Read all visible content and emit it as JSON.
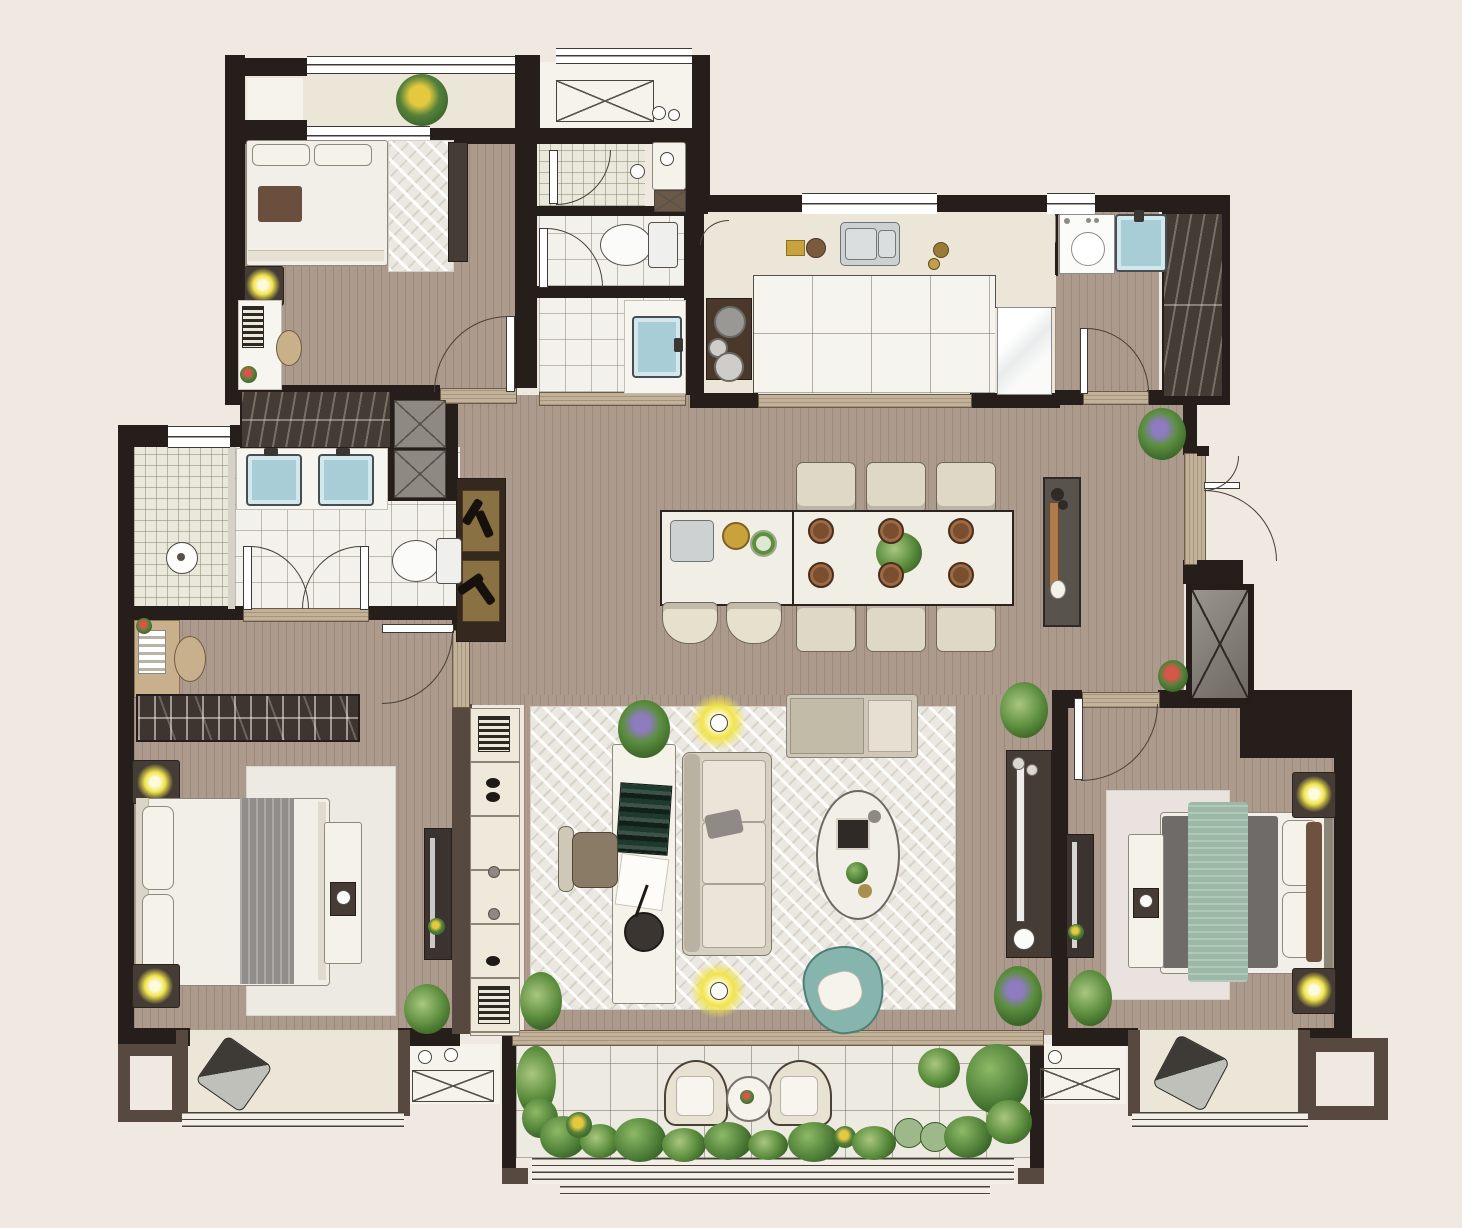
{
  "scene": {
    "type": "residential-floor-plan",
    "view": "top-down-render",
    "canvas_width": 1462,
    "canvas_height": 1228
  },
  "colors": {
    "bg": "#EFE9E1",
    "wall": "#261E1B",
    "wallSoft": "#57493F",
    "wood": "#AC9B8D",
    "woodLine": "rgba(74,52,40,0.16)",
    "tile": "#F3F1EB",
    "tileLine": "rgba(125,118,106,0.45)",
    "marble": "#EBE6D8",
    "balconyTile": "#EDEAE2",
    "showerTile": "#E9E8DB",
    "counter": "#F7F5EF",
    "stoneSill": "#C3B29A",
    "whiteFurn": "#F5F2EA",
    "darkFurn": "#453C36",
    "bed": "#F2EFE8",
    "runnerGray": "#918D8B",
    "runnerGreen": "#9BB9A6",
    "throwBrown": "#6B4F3E",
    "pillowBrown": "#6E523F",
    "teal": "#85B5AC",
    "lamp": "#F1E44C",
    "sinkBlue": "#A9CDD6",
    "stainless": "#CDD1D2",
    "glass": "#D6D2C8",
    "rug": "#EBE8E2",
    "tv": "#EDEDEB",
    "plantDark": "#2C521F",
    "plantMid": "#4F7F38",
    "plantLight": "#8CBA66"
  },
  "rooms": [
    {
      "id": "balcony-top-left",
      "items": [
        "potted-plant",
        "railing-window",
        "marble-floor"
      ]
    },
    {
      "id": "bedroom-guest",
      "items": [
        "double-bed",
        "brown-throw",
        "area-rug",
        "dresser",
        "nightstand-with-lamp",
        "desk",
        "stool",
        "built-in-wardrobe"
      ]
    },
    {
      "id": "bathroom-guest",
      "items": [
        "shower-room",
        "toilet",
        "vanity-sink",
        "service-shaft",
        "door-swing-x3"
      ]
    },
    {
      "id": "ac-platform-north",
      "items": [
        "unit-outline-x-box",
        "vent-circles",
        "railing"
      ]
    },
    {
      "id": "kitchen",
      "items": [
        "marble-counter",
        "double-basin-steel-sink",
        "cooktop-two-burners",
        "refrigerator",
        "big-tile-work-floor",
        "service-shaft",
        "window-x2"
      ]
    },
    {
      "id": "laundry",
      "items": [
        "washing-machine",
        "utility-sink-blue",
        "door-swing"
      ]
    },
    {
      "id": "foyer",
      "items": [
        "coat-closet-hatched",
        "entry-double-door-swing",
        "service-shaft-x-box",
        "potted-plant-purple",
        "potted-plant-red"
      ]
    },
    {
      "id": "dining",
      "items": [
        "island-with-sink",
        "fruit-bowls",
        "bar-stool-x2",
        "dining-table",
        "dining-chair-x6",
        "place-setting-x6",
        "center-plant",
        "sideboard-with-utensils"
      ]
    },
    {
      "id": "living",
      "items": [
        "sofa-three-seat",
        "tv-console-with-tv",
        "daybed",
        "oval-coffee-table",
        "teal-lounge-chair",
        "writing-desk",
        "office-chair",
        "floor-lamp-x2",
        "herringbone-rug",
        "potted-plant-x4"
      ]
    },
    {
      "id": "master-ensuite",
      "items": [
        "walk-in-shower",
        "double-vanity-blue-sinks",
        "toilet",
        "double-door-swing",
        "walk-in-closet-hatched",
        "wine-cabinet-with-bottles",
        "shaft-x-box-x2",
        "window"
      ]
    },
    {
      "id": "master-bedroom",
      "items": [
        "king-bed",
        "gray-runner",
        "nightstand-with-lamp-x2",
        "bench-with-tray",
        "tv-panel",
        "book-shelf",
        "desk-with-books",
        "round-chair",
        "area-rug",
        "door-swing",
        "potted-plant"
      ]
    },
    {
      "id": "bookcase-partition",
      "items": [
        "open-shelving-column"
      ]
    },
    {
      "id": "bedroom-second",
      "items": [
        "double-bed",
        "green-runner",
        "gray-duvet",
        "nightstand-with-lamp-x2",
        "bench-with-tray",
        "tv-panel",
        "area-rug",
        "door-swing",
        "potted-plant"
      ]
    },
    {
      "id": "balcony-south",
      "items": [
        "armchair-x2",
        "round-side-table",
        "planting-border",
        "railing-window",
        "sliding-sill"
      ]
    },
    {
      "id": "bay-window-west",
      "items": [
        "cushion",
        "railing"
      ]
    },
    {
      "id": "bay-window-east",
      "items": [
        "cushion",
        "railing"
      ]
    },
    {
      "id": "equipment-platform-west",
      "items": [
        "ac-unit-x-box",
        "pipe-circles"
      ]
    },
    {
      "id": "equipment-platform-east",
      "items": [
        "ac-unit-x-box",
        "pipe-circle"
      ]
    },
    {
      "id": "utility-enclosure-southwest",
      "items": [
        "walled-niche"
      ]
    },
    {
      "id": "utility-enclosure-southeast",
      "items": [
        "walled-niche"
      ]
    }
  ]
}
